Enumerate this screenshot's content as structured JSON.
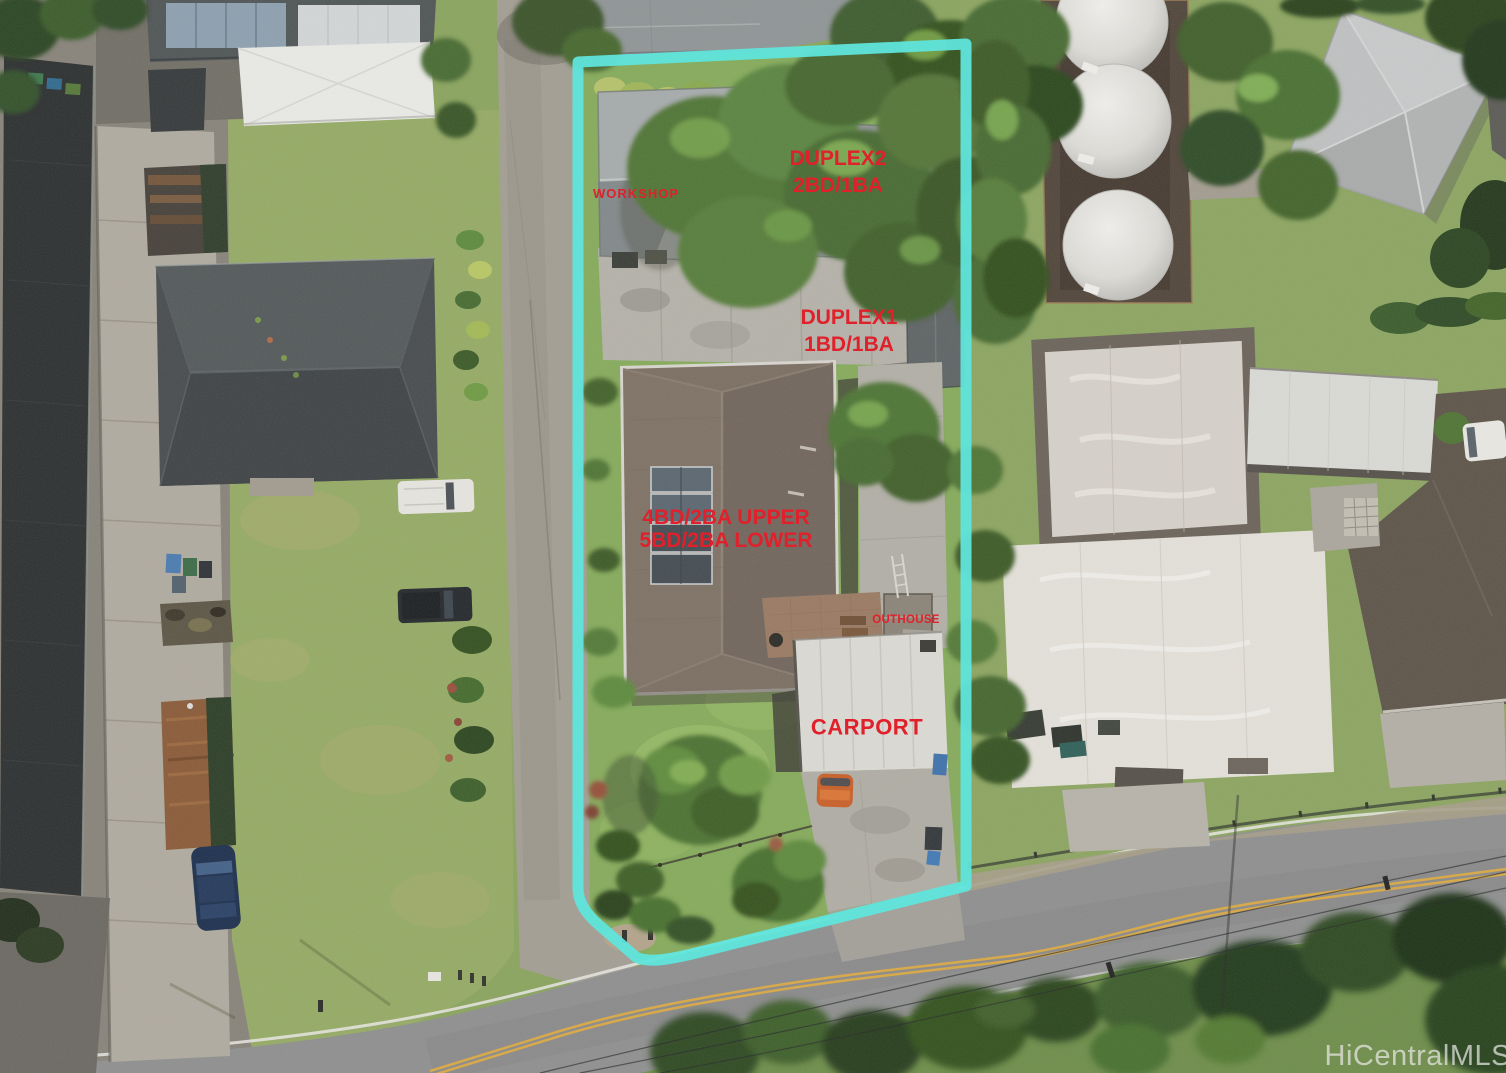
{
  "photo": {
    "watermark": "HiCentralMLS"
  },
  "colors": {
    "boundary": "#57e7de",
    "label": "#e0202a"
  },
  "labels": {
    "workshop": "WORKSHOP",
    "duplex2_line1": "DUPLEX2",
    "duplex2_line2": "2BD/1BA",
    "duplex1_line1": "DUPLEX1",
    "duplex1_line2": "1BD/1BA",
    "main_house_line1": "4BD/2BA UPPER",
    "main_house_line2": "5BD/2BA LOWER",
    "outhouse": "OUTHOUSE",
    "carport": "CARPORT"
  }
}
